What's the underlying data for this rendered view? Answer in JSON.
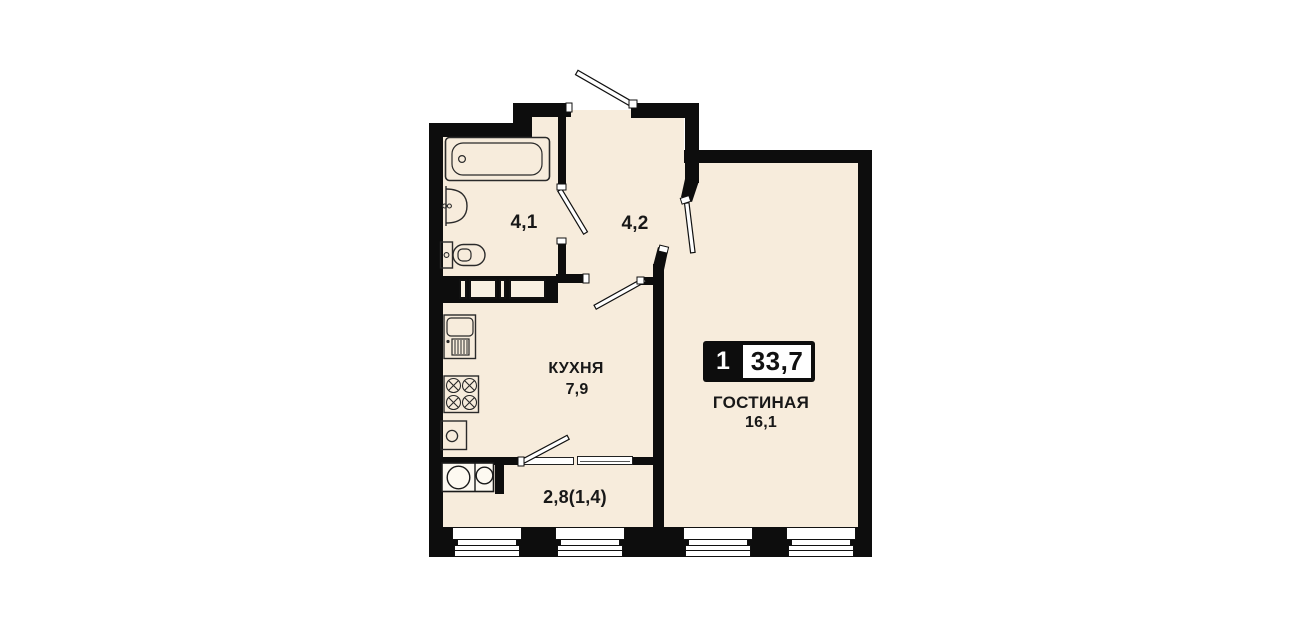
{
  "plan": {
    "title": "apartment-floor-plan",
    "badge": {
      "rooms": "1",
      "total_area": "33,7"
    },
    "rooms": [
      {
        "id": "bathroom",
        "name": "",
        "area": "4,1"
      },
      {
        "id": "hallway",
        "name": "",
        "area": "4,2"
      },
      {
        "id": "kitchen",
        "name": "КУХНЯ",
        "area": "7,9"
      },
      {
        "id": "living",
        "name": "ГОСТИНАЯ",
        "area": "16,1"
      },
      {
        "id": "balcony",
        "name": "",
        "area": "2,8(1,4)"
      }
    ],
    "fixtures": [
      "bathtub-icon",
      "washbasin-icon",
      "toilet-icon",
      "kitchen-sink-icon",
      "stove-icon",
      "oven-icon",
      "washing-machine-icon"
    ],
    "windows_count": 4,
    "doors_count": 5,
    "colors": {
      "floor": "#f7ecdc",
      "wall": "#0d0d0d",
      "background": "#ffffff",
      "badge_bg": "#0d0d0d",
      "badge_value_bg": "#ffffff"
    }
  }
}
